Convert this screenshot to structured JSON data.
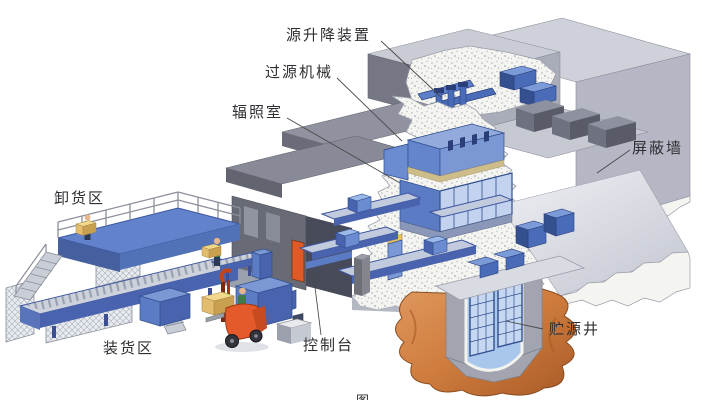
{
  "labels": {
    "source_hoist": "源升降装置",
    "source_transfer_machine": "过源机械",
    "irradiation_room": "辐照室",
    "shielding_wall": "屏蔽墙",
    "unloading_area": "卸货区",
    "loading_area": "装货区",
    "control_console": "控制台",
    "source_storage_well": "贮源井",
    "caption_fragment": "图"
  },
  "palette": {
    "background": "#ffffff",
    "concrete_light": "#ced1d9",
    "concrete_medium": "#b5b8c4",
    "concrete_dark": "#6e707c",
    "cut_concrete_white": "#f4f4f0",
    "machinery_blue": "#5b7cc4",
    "machinery_blue_light": "#c3d2ee",
    "machinery_blue_dark": "#31508f",
    "platform_blue": "#6283cc",
    "earth_brown": "#cf7c3e",
    "pool_blue": "#a9c6ec",
    "forklift_red": "#e55a2a",
    "door_orange": "#e05a28",
    "cargo_yellow": "#f2d88c",
    "worker_green": "#3f7a4e",
    "label_text": "#2f2f33",
    "leader_line": "#4a4a4a"
  }
}
